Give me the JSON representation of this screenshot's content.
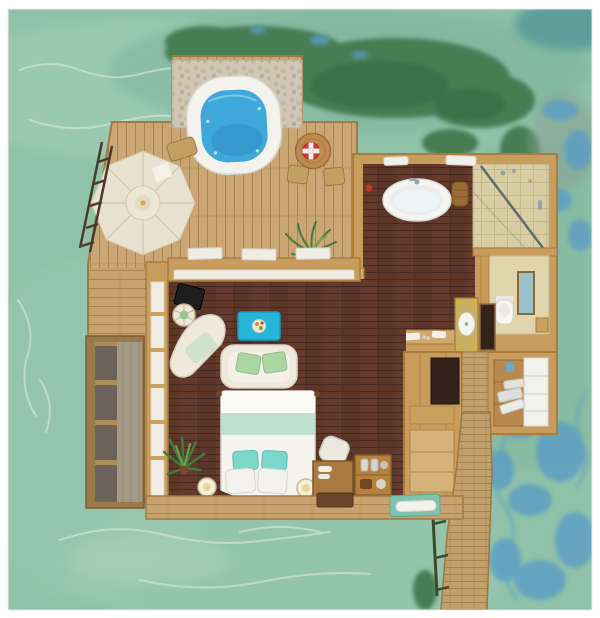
{
  "meta": {
    "title": "Overwater villa floor plan - top-down 3D rendering",
    "image_width": 600,
    "image_height": 618,
    "visible_text": "none"
  },
  "palette": {
    "frame_white": "#ffffff",
    "water_base": "#8fc2a8",
    "water_light": "#a9d2ba",
    "water_shade": "#79b29a",
    "water_foam": "#d9ecdc",
    "seagrass_green": "#477d52",
    "seagrass_dark": "#3a6f47",
    "water_blue": "#5a9dc4",
    "teal_corner": "#4f9297",
    "gray_patch": "#8aa093",
    "deck_wood": "#c9a673",
    "deck_edge": "#a07a42",
    "wall_wood": "#c89c5c",
    "wall_edge": "#a97c3c",
    "interior_floor": "#5d362a",
    "pebble_mat": "#cfc7b3",
    "tub_rim": "#f3f2ec",
    "tub_water": "#3fa8da",
    "tub_water_deep": "#2f90c6",
    "parasol_canopy": "#e9e1cf",
    "parasol_rib": "#d2c6ad",
    "table_rattan": "#c08a4e",
    "life_ring_red": "#cc3b35",
    "chair_khaki": "#c3a163",
    "steps_dark": "#6b635a",
    "steps_landing": "#a59a86",
    "bathtub_white": "#f4f4f1",
    "tile_beige": "#d9cda4",
    "glass_frame": "#55626a",
    "mirror_blue": "#9cc0cc",
    "vanity_gold": "#c9ae66",
    "brass_knob": "#d9b23c",
    "panel_dark": "#33231c",
    "toilet_white": "#f6f6f3",
    "closet_white": "#f1f1ee",
    "linen_gray": "#dfdeda",
    "shelf_wood": "#b98a4e",
    "tv_dark": "#32241c",
    "sofa_cream": "#efe9dd",
    "pillow_mint": "#abd6a4",
    "coffee_table": "#25b5d6",
    "chaise_white": "#eee9dc",
    "cushion_mint": "#cfe3cc",
    "bed_linen": "#f4f3ee",
    "runner_mint": "#bfe0cf",
    "pillow_teal": "#7bd8cb",
    "headboard": "#5f3723",
    "plant_green": "#3e7c3c",
    "lamp_white": "#f6efdc",
    "desk_black": "#1e1e1e",
    "desk_wood": "#a87a42",
    "minibar_wood": "#b5813f",
    "tray_brown": "#6b4629",
    "mat_teal": "#7fc3ae",
    "towel_white": "#f4f2ea",
    "railing_dark": "#3c4a2e",
    "walkway_wood": "#c2a06c"
  },
  "areas": [
    {
      "id": "ocean",
      "label": "turquoise lagoon water"
    },
    {
      "id": "sun-deck",
      "label": "wooden sun deck terrace"
    },
    {
      "id": "jacuzzi-area",
      "label": "outdoor jacuzzi on pebble mat"
    },
    {
      "id": "parasol-area",
      "label": "octagonal parasol corner"
    },
    {
      "id": "dining-area",
      "label": "outdoor dining set"
    },
    {
      "id": "water-steps",
      "label": "steps down to the water"
    },
    {
      "id": "bedroom",
      "label": "bedroom with dark hardwood floor"
    },
    {
      "id": "bathroom",
      "label": "bathroom with freestanding tub"
    },
    {
      "id": "shower",
      "label": "glass walk-in shower"
    },
    {
      "id": "toilet-room",
      "label": "separate toilet room"
    },
    {
      "id": "vanity",
      "label": "double vanity with gold sinks"
    },
    {
      "id": "closet",
      "label": "walk-in closet with linen shelves"
    },
    {
      "id": "entry",
      "label": "entry landing"
    },
    {
      "id": "walkway",
      "label": "wooden jetty walkway"
    }
  ],
  "furniture": [
    {
      "id": "hot-tub",
      "label": "round jacuzzi with blue water"
    },
    {
      "id": "pebble-mat",
      "label": "pebble mosaic mat"
    },
    {
      "id": "parasol",
      "label": "cream octagonal umbrella"
    },
    {
      "id": "deck-ladder",
      "label": "swim ladder into lagoon"
    },
    {
      "id": "dining-table",
      "label": "round rattan table"
    },
    {
      "id": "life-ring",
      "label": "red and white life ring decor"
    },
    {
      "id": "dining-chair",
      "label": "khaki deck chairs"
    },
    {
      "id": "lounge-chair",
      "label": "folded khaki lounger"
    },
    {
      "id": "bathtub",
      "label": "white oval freestanding bathtub"
    },
    {
      "id": "shower-glass",
      "label": "glass shower screen"
    },
    {
      "id": "toilet",
      "label": "toilet"
    },
    {
      "id": "wall-mirror",
      "label": "framed mirror"
    },
    {
      "id": "sink-left",
      "label": "gold vessel sink left"
    },
    {
      "id": "sink-right",
      "label": "gold vessel sink right"
    },
    {
      "id": "towel",
      "label": "folded white towels"
    },
    {
      "id": "basket",
      "label": "woven basket"
    },
    {
      "id": "bed",
      "label": "double bed with mint runner"
    },
    {
      "id": "teal-pillow",
      "label": "teal accent pillows"
    },
    {
      "id": "white-pillow",
      "label": "white pillows"
    },
    {
      "id": "headboard",
      "label": "curved wooden headboard"
    },
    {
      "id": "sofa",
      "label": "cream loveseat with mint cushions"
    },
    {
      "id": "coffee-table",
      "label": "turquoise coffee table"
    },
    {
      "id": "chaise",
      "label": "white sculpted chaise lounge"
    },
    {
      "id": "writing-desk",
      "label": "black corner desk"
    },
    {
      "id": "fan-chair",
      "label": "round wicker chair"
    },
    {
      "id": "floor-plant",
      "label": "potted palm plants"
    },
    {
      "id": "bedside-lamp",
      "label": "spherical bedside lamps"
    },
    {
      "id": "dressing-desk",
      "label": "wooden dressing desk and chair"
    },
    {
      "id": "minibar",
      "label": "minibar caddy with bottles"
    },
    {
      "id": "serving-tray",
      "label": "dark serving tray"
    },
    {
      "id": "day-mat",
      "label": "teal bench cushion with rolled towel"
    },
    {
      "id": "tv",
      "label": "wall TV console"
    },
    {
      "id": "linen-stack",
      "label": "folded linens in closet"
    },
    {
      "id": "walkway-railing",
      "label": "dark walkway railing"
    }
  ]
}
